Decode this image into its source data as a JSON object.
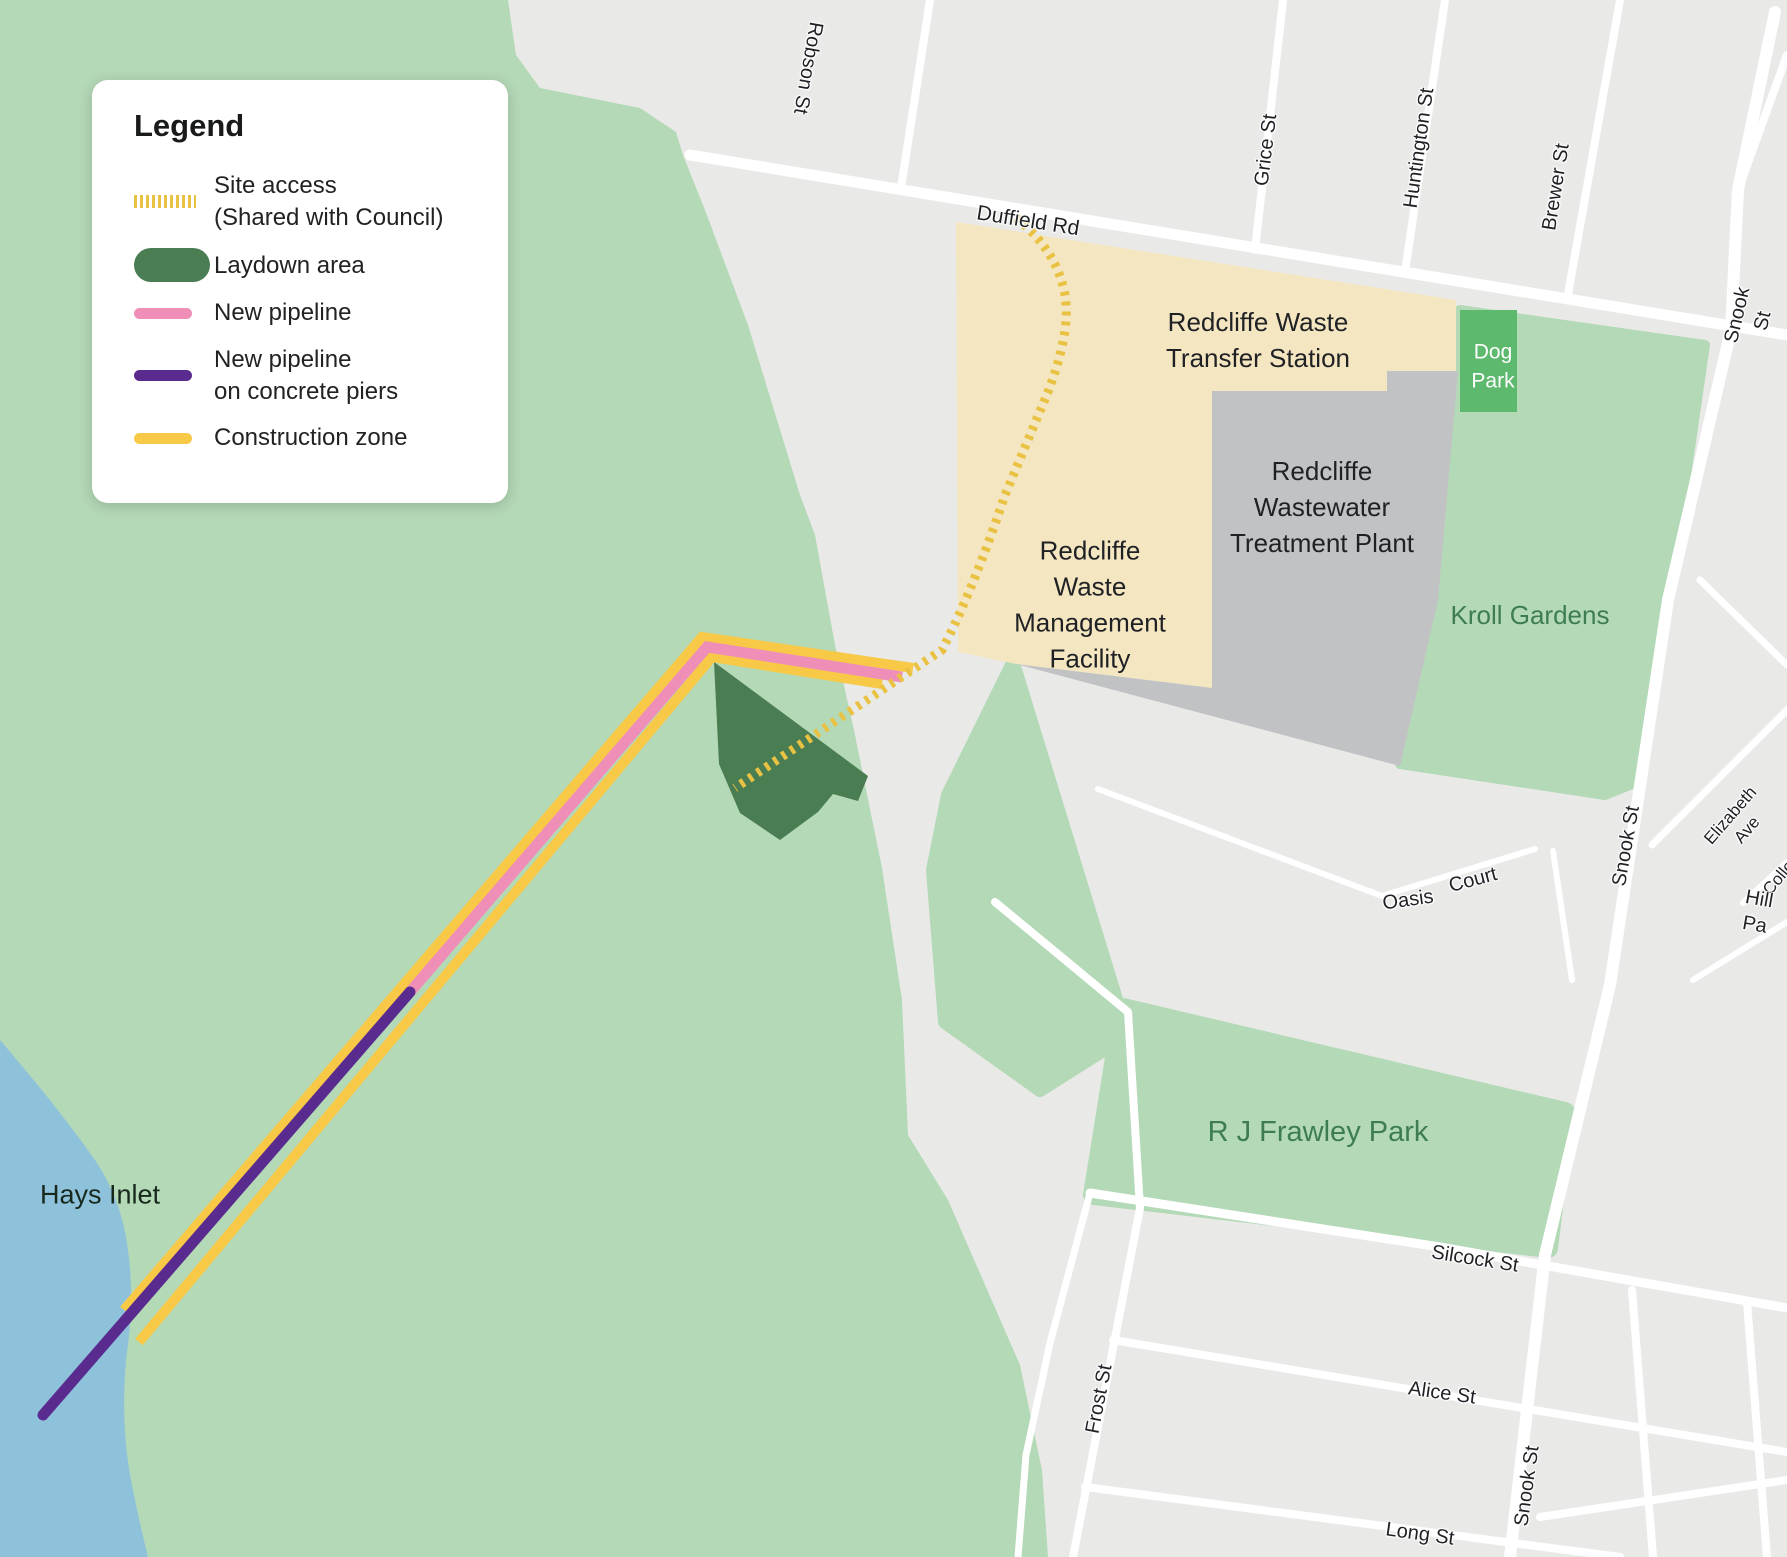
{
  "colors": {
    "urban": "#e9eae8",
    "nature": "#b4d9b7",
    "water": "#8ec2da",
    "facility": "#f4e6c0",
    "plant": "#c1c2c4",
    "dogpark": "#5db96d",
    "laydown": "#4b7d52",
    "pink": "#ef8fb8",
    "purple": "#5a2b8f",
    "construction": "#f8c847",
    "siteaccess": "#e9c243",
    "road": "#ffffff",
    "labeldark": "#1f2125",
    "labelgreen": "#3d7d4f"
  },
  "legend": {
    "title": "Legend",
    "items": [
      {
        "id": "site-access",
        "label": "Site access\n(Shared with Council)"
      },
      {
        "id": "laydown-area",
        "label": "Laydown area"
      },
      {
        "id": "new-pipeline",
        "label": "New pipeline"
      },
      {
        "id": "new-pipeline-piers",
        "label": "New pipeline\non concrete piers"
      },
      {
        "id": "construction-zone",
        "label": "Construction zone"
      }
    ]
  },
  "map": {
    "labels": [
      {
        "name": "robson-st-label",
        "text": "Robson St",
        "x": 808,
        "y": 68,
        "rot": 100,
        "cls": "street"
      },
      {
        "name": "duffield-rd-label",
        "text": "Duffield Rd",
        "x": 1028,
        "y": 221,
        "rot": 9,
        "cls": "street-lg"
      },
      {
        "name": "grice-st-label",
        "text": "Grice St",
        "x": 1266,
        "y": 150,
        "rot": -83,
        "cls": "street"
      },
      {
        "name": "huntington-st-label",
        "text": "Huntington St",
        "x": 1419,
        "y": 148,
        "rot": -82,
        "cls": "street"
      },
      {
        "name": "brewer-st-label",
        "text": "Brewer St",
        "x": 1556,
        "y": 187,
        "rot": -81,
        "cls": "street"
      },
      {
        "name": "snook-st-top-label",
        "text": "Snook St",
        "x": 1750,
        "y": 318,
        "rot": -77,
        "cls": "street"
      },
      {
        "name": "snook-st-mid-label",
        "text": "Snook St",
        "x": 1626,
        "y": 846,
        "rot": -80,
        "cls": "street"
      },
      {
        "name": "snook-st-bottom-label",
        "text": "Snook St",
        "x": 1527,
        "y": 1486,
        "rot": -82,
        "cls": "street"
      },
      {
        "name": "frost-st-label",
        "text": "Frost St",
        "x": 1099,
        "y": 1399,
        "rot": -79,
        "cls": "street"
      },
      {
        "name": "silcock-st-label",
        "text": "Silcock St",
        "x": 1475,
        "y": 1259,
        "rot": 9,
        "cls": "street"
      },
      {
        "name": "alice-st-label",
        "text": "Alice St",
        "x": 1442,
        "y": 1393,
        "rot": 8,
        "cls": "street"
      },
      {
        "name": "long-st-label",
        "text": "Long St",
        "x": 1420,
        "y": 1534,
        "rot": 8,
        "cls": "street"
      },
      {
        "name": "oasis-court-label-1",
        "text": "Oasis",
        "x": 1408,
        "y": 900,
        "rot": -8,
        "cls": "street"
      },
      {
        "name": "oasis-court-label-2",
        "text": "Court",
        "x": 1473,
        "y": 880,
        "rot": -15,
        "cls": "street"
      },
      {
        "name": "elizabeth-ave-label",
        "text": "Elizabeth Ave",
        "x": 1739,
        "y": 823,
        "rot": -49,
        "cls": "street-sm"
      },
      {
        "name": "college-label",
        "text": "Colle",
        "x": 1779,
        "y": 878,
        "rot": -50,
        "cls": "street-sm"
      },
      {
        "name": "hill-pa-label",
        "text": "Hill Pa",
        "x": 1757,
        "y": 912,
        "rot": 10,
        "cls": "street"
      },
      {
        "name": "hays-inlet-label",
        "text": "Hays Inlet",
        "x": 100,
        "y": 1195,
        "rot": 0,
        "cls": "water-lbl"
      },
      {
        "name": "kroll-gardens-label",
        "text": "Kroll Gardens",
        "x": 1530,
        "y": 616,
        "rot": 0,
        "cls": "green-lbl"
      },
      {
        "name": "frawley-park-label",
        "text": "R J Frawley Park",
        "x": 1318,
        "y": 1133,
        "rot": 0,
        "cls": "green-lbl-lg"
      },
      {
        "name": "dog-park-label",
        "text": "Dog\nPark",
        "x": 1493,
        "y": 367,
        "rot": 0,
        "cls": "white-lbl"
      },
      {
        "name": "transfer-station-label",
        "text": "Redcliffe Waste\nTransfer Station",
        "x": 1258,
        "y": 341,
        "rot": 0,
        "cls": "area-lbl"
      },
      {
        "name": "treatment-plant-label",
        "text": "Redcliffe\nWastewater\nTreatment Plant",
        "x": 1322,
        "y": 508,
        "rot": 0,
        "cls": "area-lbl"
      },
      {
        "name": "management-facility-label",
        "text": "Redcliffe\nWaste\nManagement\nFacility",
        "x": 1090,
        "y": 605,
        "rot": 0,
        "cls": "area-lbl"
      }
    ]
  }
}
